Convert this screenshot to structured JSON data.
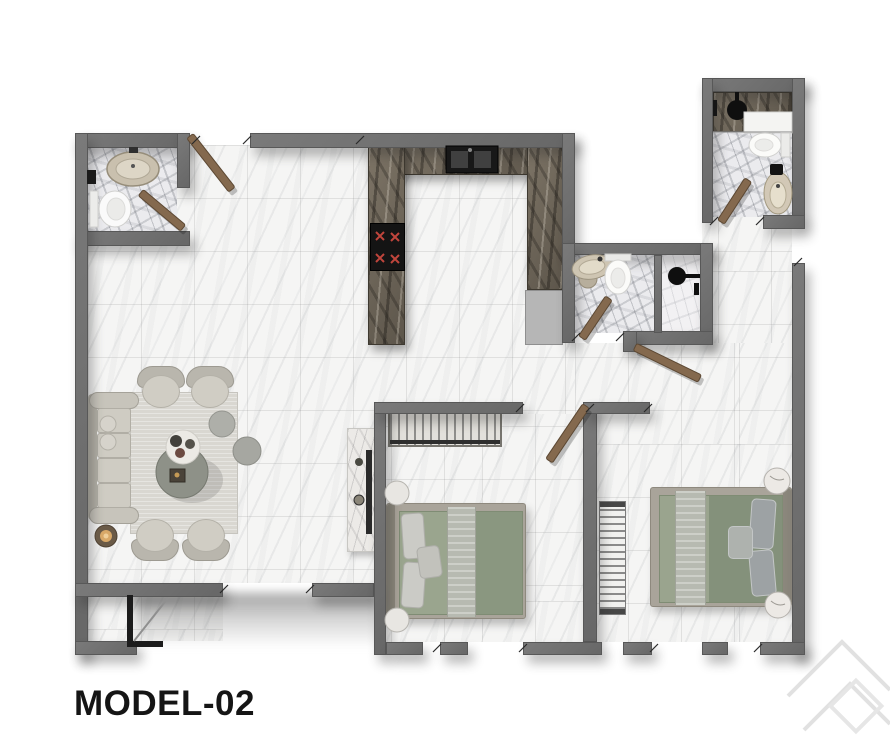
{
  "plan": {
    "label": "MODEL-02",
    "rooms": [
      "living-dining-room",
      "kitchen",
      "bathroom-top-left",
      "bathroom-middle",
      "shower-middle",
      "bathroom-top-right",
      "bedroom-1",
      "bedroom-2",
      "hallway",
      "entry-vestibule",
      "terrace-opening"
    ],
    "furniture": [
      "sofa",
      "armchair",
      "coffee-table",
      "serving-tray",
      "pouf",
      "floor-lamp-table",
      "tv-console",
      "kitchen-counter",
      "kitchen-sink",
      "cooktop",
      "fridge",
      "wardrobe",
      "double-bed",
      "nightstand-pouf",
      "radiator",
      "toilet",
      "washbasin",
      "shower-head",
      "shower-bench",
      "door-leaf",
      "entry-door",
      "window-opening",
      "watermark-chevrons"
    ]
  },
  "palette": {
    "bg": "#ffffff",
    "wall": "#7a7a7a",
    "wall_dark": "#676767",
    "floor": "#f5f5f4",
    "bath_floor": "#ebebee",
    "counter": "#6e665a",
    "appliance_black": "#141414",
    "fridge": "#b6b6b6",
    "door_wood": "#84694e",
    "door_wood_edge": "#5c4833",
    "sofa": "#cfccc3",
    "bed_frame": "#a9a49a",
    "mattress": "#8f9b84",
    "blanket": "#b7bab1",
    "pillow": "#cbcbc6",
    "rug": "#d9d7d1",
    "burner": "#c0453c",
    "text": "#151515",
    "watermark": "#dedede"
  }
}
